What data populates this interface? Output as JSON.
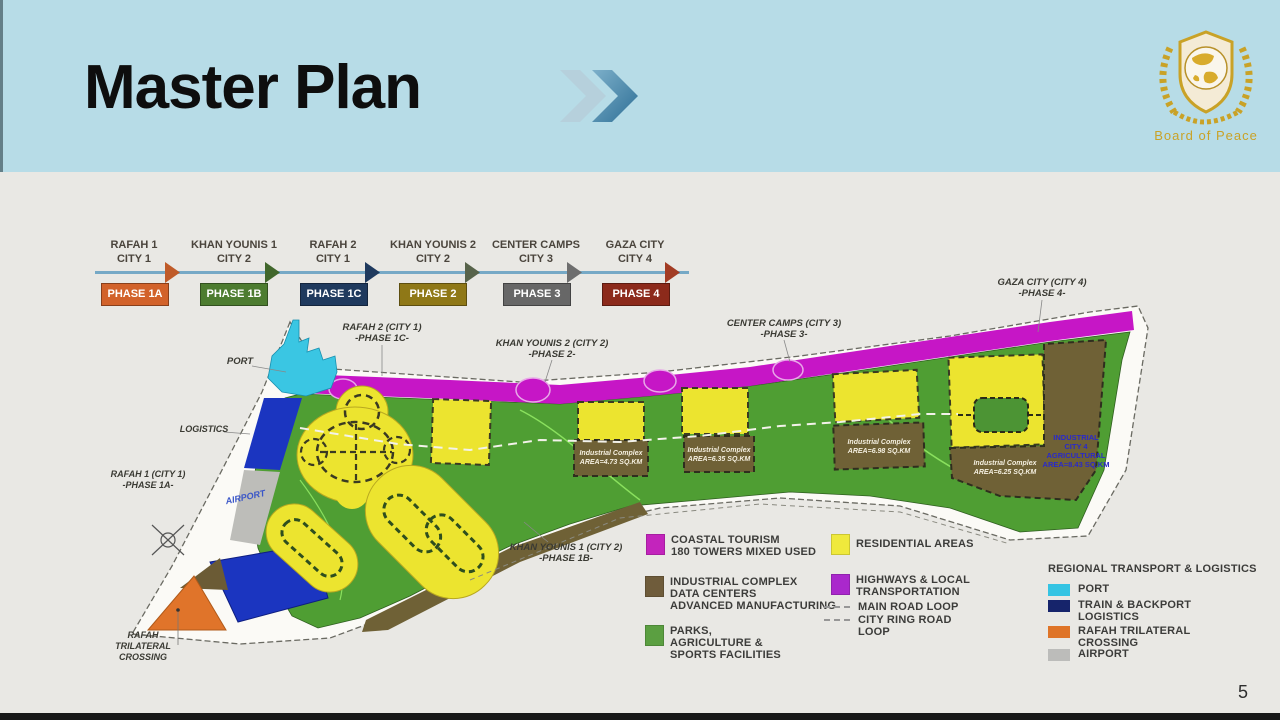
{
  "slide": {
    "title": "Master Plan",
    "page_number": "5"
  },
  "logo": {
    "text": "Board of Peace",
    "accent_gold": "#c9a227"
  },
  "timeline": {
    "steps": [
      {
        "city": "RAFAH 1",
        "city_num": "CITY 1",
        "phase": "PHASE 1A",
        "color": "#d2622a",
        "arrow_color": "#bf5b29"
      },
      {
        "city": "KHAN YOUNIS 1",
        "city_num": "CITY 2",
        "phase": "PHASE 1B",
        "color": "#4d7c30",
        "arrow_color": "#41672c"
      },
      {
        "city": "RAFAH 2",
        "city_num": "CITY 1",
        "phase": "PHASE 1C",
        "color": "#1f3a5e",
        "arrow_color": "#1f3a5e"
      },
      {
        "city": "KHAN YOUNIS 2",
        "city_num": "CITY 2",
        "phase": "PHASE 2",
        "color": "#8f7817",
        "arrow_color": "#57634a"
      },
      {
        "city": "CENTER CAMPS",
        "city_num": "CITY 3",
        "phase": "PHASE 3",
        "color": "#676767",
        "arrow_color": "#6e6e6e"
      },
      {
        "city": "GAZA CITY",
        "city_num": "CITY 4",
        "phase": "PHASE 4",
        "color": "#8c2a1b",
        "arrow_color": "#a23c24"
      }
    ]
  },
  "map": {
    "labels": {
      "rafah2_l1": "RAFAH 2 (CITY 1)",
      "rafah2_l2": "-PHASE 1C-",
      "port": "PORT",
      "ky2_l1": "KHAN YOUNIS 2 (CITY 2)",
      "ky2_l2": "-PHASE 2-",
      "cc_l1": "CENTER CAMPS (CITY 3)",
      "cc_l2": "-PHASE 3-",
      "gc_l1": "GAZA CITY (CITY 4)",
      "gc_l2": "-PHASE 4-",
      "logistics": "LOGISTICS",
      "rafah1_l1": "RAFAH 1 (CITY 1)",
      "rafah1_l2": "-PHASE 1A-",
      "airport": "AIRPORT",
      "ky1_l1": "KHAN YOUNIS 1 (CITY 2)",
      "ky1_l2": "-PHASE 1B-",
      "rtc_l1": "RAFAH",
      "rtc_l2": "TRILATERAL",
      "rtc_l3": "CROSSING",
      "ic1_l1": "Industrial Complex",
      "ic1_l2": "AREA=4.73 SQ.KM",
      "ic2_l1": "Industrial Complex",
      "ic2_l2": "AREA=6.35 SQ.KM",
      "ic3_l1": "Industrial Complex",
      "ic3_l2": "AREA=6.98 SQ.KM",
      "ic4_l1": "Industrial Complex",
      "ic4_l2": "AREA=6.25 SQ.KM",
      "icity_l1": "INDUSTRIAL",
      "icity_l2": "CITY 4",
      "icity_l3": "AGRICULTURAL",
      "icity_l4": "AREA=8.43 SQ.KM"
    },
    "colors": {
      "coastal_highway": "#c616c6",
      "residential": "#ece42f",
      "industrial": "#6f6136",
      "parks": "#4f9e33",
      "port": "#3ac6e3",
      "train": "#1b35c0",
      "crossing": "#e0742a",
      "airport": "#bdbdb9"
    }
  },
  "legend": {
    "coastal": {
      "swatch": "#c324bc",
      "l1": "COASTAL TOURISM",
      "l2": "180 TOWERS MIXED USED"
    },
    "residential": {
      "swatch": "#efe93c",
      "l1": "RESIDENTIAL AREAS"
    },
    "industrial": {
      "swatch": "#6f5c3b",
      "l1": "INDUSTRIAL COMPLEX",
      "l2": "DATA CENTERS",
      "l3": "ADVANCED MANUFACTURING"
    },
    "highways": {
      "swatch": "#aa28cc",
      "l1": "HIGHWAYS & LOCAL",
      "l2": "TRANSPORTATION"
    },
    "main_road": "MAIN ROAD LOOP",
    "ring_road_l1": "CITY RING ROAD",
    "ring_road_l2": "LOOP",
    "parks": {
      "swatch": "#5b9f41",
      "l1": "PARKS,",
      "l2": "AGRICULTURE &",
      "l3": "SPORTS FACILITIES"
    }
  },
  "regional": {
    "title": "REGIONAL TRANSPORT & LOGISTICS",
    "port": {
      "swatch": "#35c4e3",
      "l1": "PORT"
    },
    "train": {
      "swatch": "#16246b",
      "l1": "TRAIN & BACKPORT",
      "l2": "LOGISTICS"
    },
    "crossing": {
      "swatch": "#df7427",
      "l1": "RAFAH TRILATERAL",
      "l2": "CROSSING"
    },
    "airport": {
      "swatch": "#bcbcba",
      "l1": "AIRPORT"
    }
  }
}
